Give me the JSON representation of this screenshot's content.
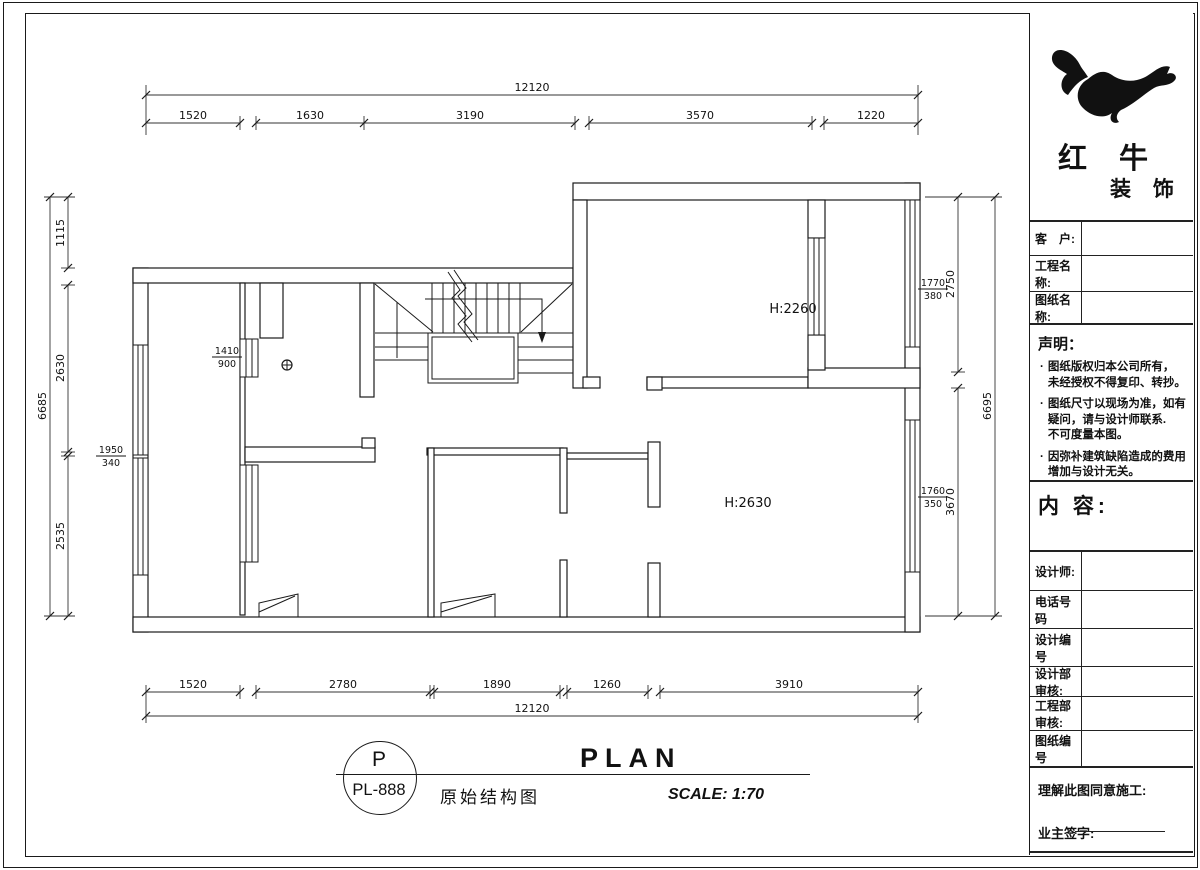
{
  "brand": {
    "line1": "红 牛",
    "line2": "装 饰"
  },
  "title_block": {
    "fields": [
      {
        "label": "客　户:"
      },
      {
        "label": "工程名称:"
      },
      {
        "label": "图纸名称:"
      }
    ],
    "statement_title": "声明：",
    "statement_items": [
      "图纸版权归本公司所有，\n未经授权不得复印、转抄。",
      "图纸尺寸以现场为准，如有\n疑问，请与设计师联系.\n不可度量本图。",
      "因弥补建筑缺陷造成的费用\n增加与设计无关。"
    ],
    "content_label": "内 容:",
    "rows": [
      {
        "label": "设计师:"
      },
      {
        "label": "电话号码"
      },
      {
        "label": "设计编号"
      },
      {
        "label": "设计部审核:"
      },
      {
        "label": "工程部审核:"
      },
      {
        "label": "图纸编号"
      }
    ],
    "footer_line1": "理解此图同意施工:",
    "footer_line2": "业主签字:"
  },
  "title_bar": {
    "circle_top": "P",
    "circle_bottom": "PL-888",
    "plan_word": "PLAN",
    "drawing_name": "原始结构图",
    "scale": "SCALE: 1:70"
  },
  "plan": {
    "room_labels": [
      {
        "text": "H:2260"
      },
      {
        "text": "H:2630"
      }
    ],
    "fractions": [
      {
        "num": "1410",
        "den": "900"
      },
      {
        "num": "1950",
        "den": "340"
      },
      {
        "num": "1770",
        "den": "380"
      },
      {
        "num": "1760",
        "den": "350"
      }
    ],
    "dims": {
      "top_total": "12120",
      "top_segments": [
        "1520",
        "1630",
        "3190",
        "3570",
        "1220"
      ],
      "bottom_segments": [
        "1520",
        "2780",
        "1890",
        "1260",
        "3910"
      ],
      "bottom_total": "12120",
      "left_segments": [
        "1115",
        "2630",
        "2535"
      ],
      "left_total": "6685",
      "right_segments": [
        "2750",
        "3670"
      ],
      "right_total": "6695"
    },
    "colors": {
      "line": "#1a1a1a",
      "background": "#ffffff"
    }
  }
}
